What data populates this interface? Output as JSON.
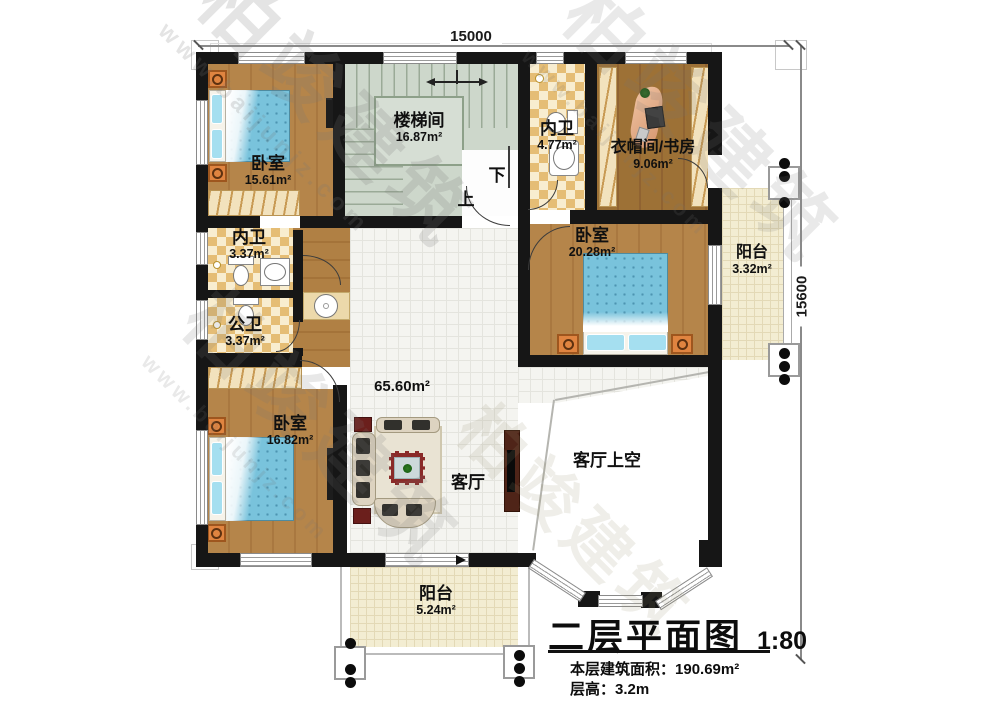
{
  "dimensions": {
    "top": "15000",
    "right": "15600"
  },
  "watermark": {
    "brand": "柏竣建筑",
    "url": "www.baijunjz.com"
  },
  "stair_marks": {
    "down": "下",
    "up": "上"
  },
  "rooms": {
    "stairwell": {
      "name": "楼梯间",
      "area": "16.87m²"
    },
    "bath_top": {
      "name": "内卫",
      "area": "4.77m²"
    },
    "cloak_study": {
      "name": "衣帽间/书房",
      "area": "9.06m²"
    },
    "bedroom_tl": {
      "name": "卧室",
      "area": "15.61m²"
    },
    "bath_mid": {
      "name": "内卫",
      "area": "3.37m²"
    },
    "bath_pub": {
      "name": "公卫",
      "area": "3.37m²"
    },
    "bedroom_bl": {
      "name": "卧室",
      "area": "16.82m²"
    },
    "bedroom_r": {
      "name": "卧室",
      "area": "20.28m²"
    },
    "living": {
      "name": "客厅",
      "area": "65.60m²"
    },
    "living_void": {
      "name": "客厅上空"
    },
    "balcony_r": {
      "name": "阳台",
      "area": "3.32m²"
    },
    "balcony_b": {
      "name": "阳台",
      "area": "5.24m²"
    }
  },
  "title_block": {
    "title": "二层平面图",
    "scale": "1:80",
    "area_label": "本层建筑面积：",
    "area_value": "190.69m²",
    "height_label": "层高：",
    "height_value": "3.2m"
  }
}
